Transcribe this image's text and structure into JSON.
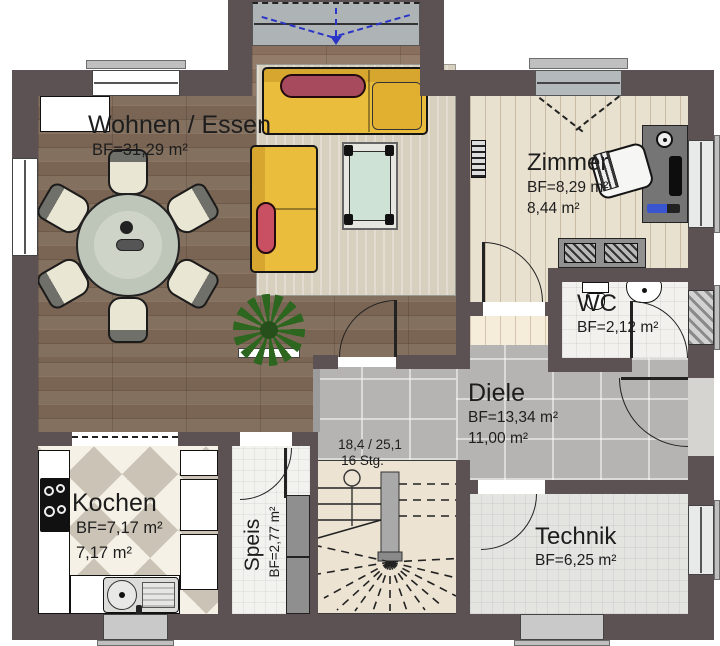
{
  "rooms": {
    "wohnen": {
      "name": "Wohnen / Essen",
      "bf": "BF=31,29 m²"
    },
    "zimmer": {
      "name": "Zimmer",
      "bf": "BF=8,29 m²",
      "area": "8,44 m²"
    },
    "wc": {
      "name": "WC",
      "bf": "BF=2,12 m²"
    },
    "diele": {
      "name": "Diele",
      "bf": "BF=13,34 m²",
      "area": "11,00 m²"
    },
    "kochen": {
      "name": "Kochen",
      "bf": "BF=7,17 m²",
      "area": "7,17 m²"
    },
    "speis": {
      "name": "Speis",
      "bf": "BF=2,77 m²"
    },
    "technik": {
      "name": "Technik",
      "bf": "BF=6,25 m²"
    }
  },
  "stairs": {
    "riser_tread": "18,4 / 25,1",
    "step_count": "16 Stg."
  },
  "colors": {
    "wall": "#5c5254",
    "wood_dark": "#7c6758",
    "wood_light": "#e9e1d0",
    "tile_gray": "#b5b4b2",
    "sofa_yellow": "#eabd3c",
    "pillow_red": "#a84a5e",
    "rug": "#d8d0bf",
    "glass_blue_arrow": "#2a35c8",
    "label": "#1d1d1d"
  }
}
